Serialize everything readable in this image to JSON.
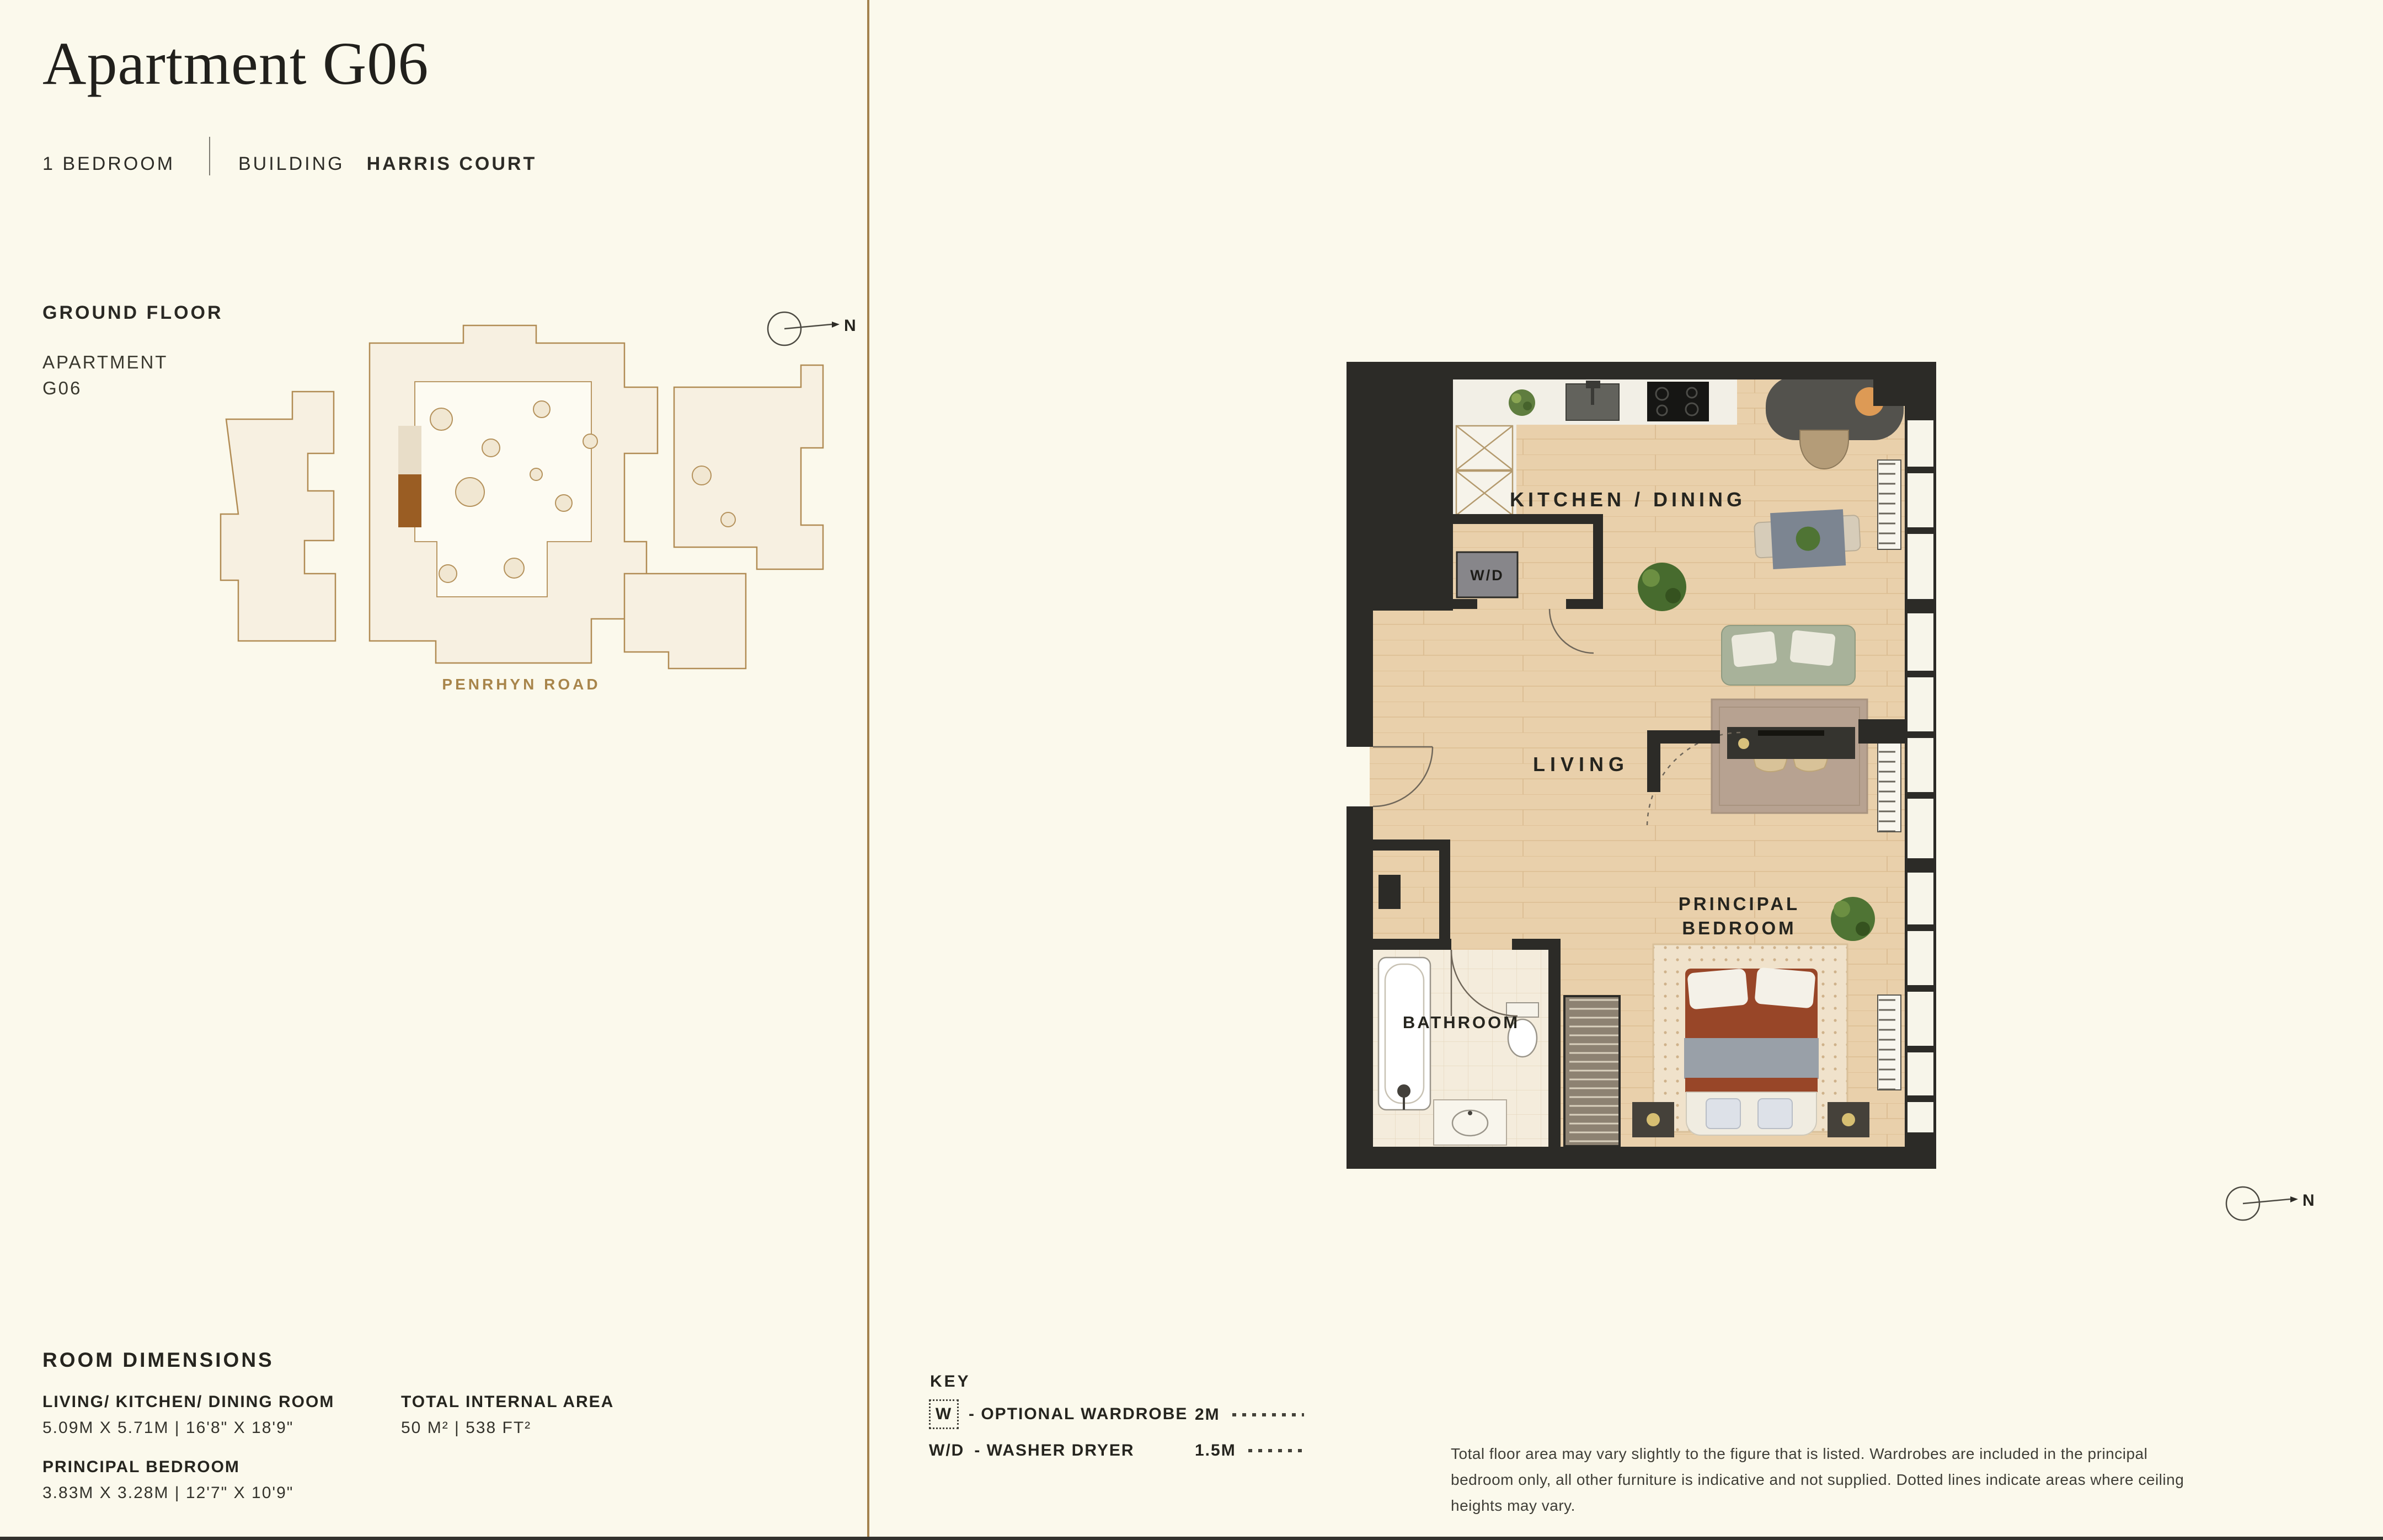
{
  "page": {
    "background": "#fbf9ec",
    "divider_color": "#a3824e"
  },
  "header": {
    "title": "Apartment G06",
    "bedrooms": "1 BEDROOM",
    "building_label": "BUILDING",
    "building_name": "HARRIS COURT"
  },
  "site_plan": {
    "floor_label": "GROUND FLOOR",
    "apartment_line1": "APARTMENT",
    "apartment_line2": "G06",
    "road_label": "PENRHYN ROAD",
    "north_label": "N",
    "outline_color": "#b18c54",
    "highlight_color": "#9a5d23"
  },
  "floor_plan": {
    "labels": {
      "kitchen_dining": "KITCHEN / DINING",
      "living": "LIVING",
      "principal_bedroom_line1": "PRINCIPAL",
      "principal_bedroom_line2": "BEDROOM",
      "bathroom": "BATHROOM",
      "washer_dryer": "W/D"
    },
    "north_label": "N",
    "colors": {
      "wall": "#2c2b27",
      "floor_wood": "#e9d0ab",
      "floor_tile": "#f4ecdc",
      "counter": "#f2efe6"
    }
  },
  "room_dimensions": {
    "heading": "ROOM DIMENSIONS",
    "rows": [
      {
        "room": "LIVING/ KITCHEN/ DINING ROOM",
        "dimensions": "5.09M X 5.71M | 16'8\" X 18'9\""
      },
      {
        "room": "PRINCIPAL BEDROOM",
        "dimensions": "3.83M X 3.28M | 12'7\" X 10'9\""
      }
    ],
    "total": {
      "label": "TOTAL INTERNAL AREA",
      "value": "50 M² | 538 FT²"
    }
  },
  "key": {
    "heading": "KEY",
    "wardrobe": {
      "symbol": "W",
      "description": "- OPTIONAL WARDROBE"
    },
    "washer": {
      "symbol": "W/D",
      "description": "- WASHER DRYER"
    },
    "ceiling_heights": [
      {
        "label": "2M"
      },
      {
        "label": "1.5M"
      }
    ]
  },
  "disclaimer": "Total floor area may vary slightly to the figure that is listed. Wardrobes are included in the principal bedroom only, all other furniture is indicative and not supplied. Dotted lines indicate areas where ceiling heights may vary."
}
